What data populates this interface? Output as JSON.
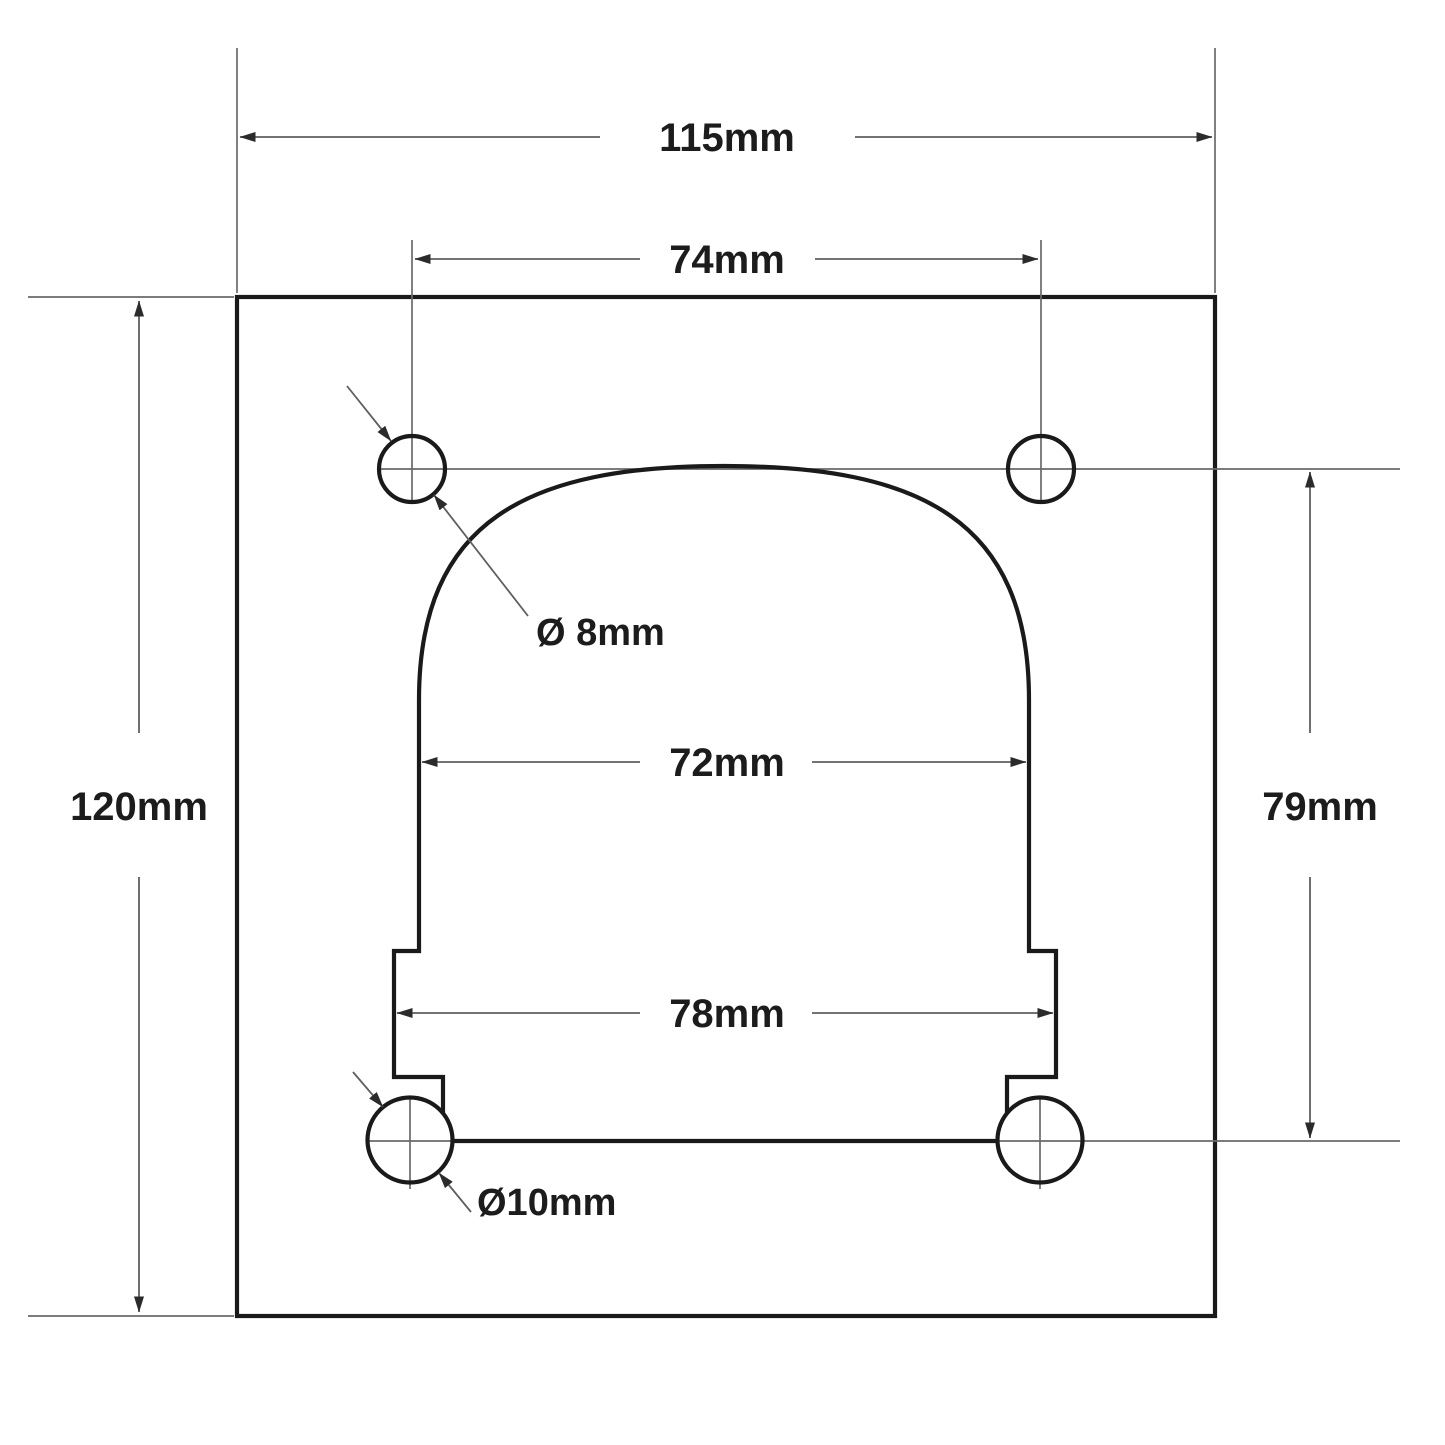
{
  "drawing": {
    "type": "technical-dimension-drawing",
    "subject": "mounting-plate-with-arched-cutout-and-four-holes",
    "labels": {
      "plate_width": "115mm",
      "top_hole_spacing": "74mm",
      "plate_height": "120mm",
      "hole_row_spacing": "79mm",
      "cutout_upper_width": "72mm",
      "cutout_lower_width": "78mm",
      "top_hole_diameter": "Ø 8mm",
      "bottom_hole_diameter": "Ø10mm"
    },
    "colors": {
      "background": "#ffffff",
      "outline": "#1a1a1a",
      "thin_line": "#6a6a6a",
      "text": "#1c1c1c"
    }
  }
}
